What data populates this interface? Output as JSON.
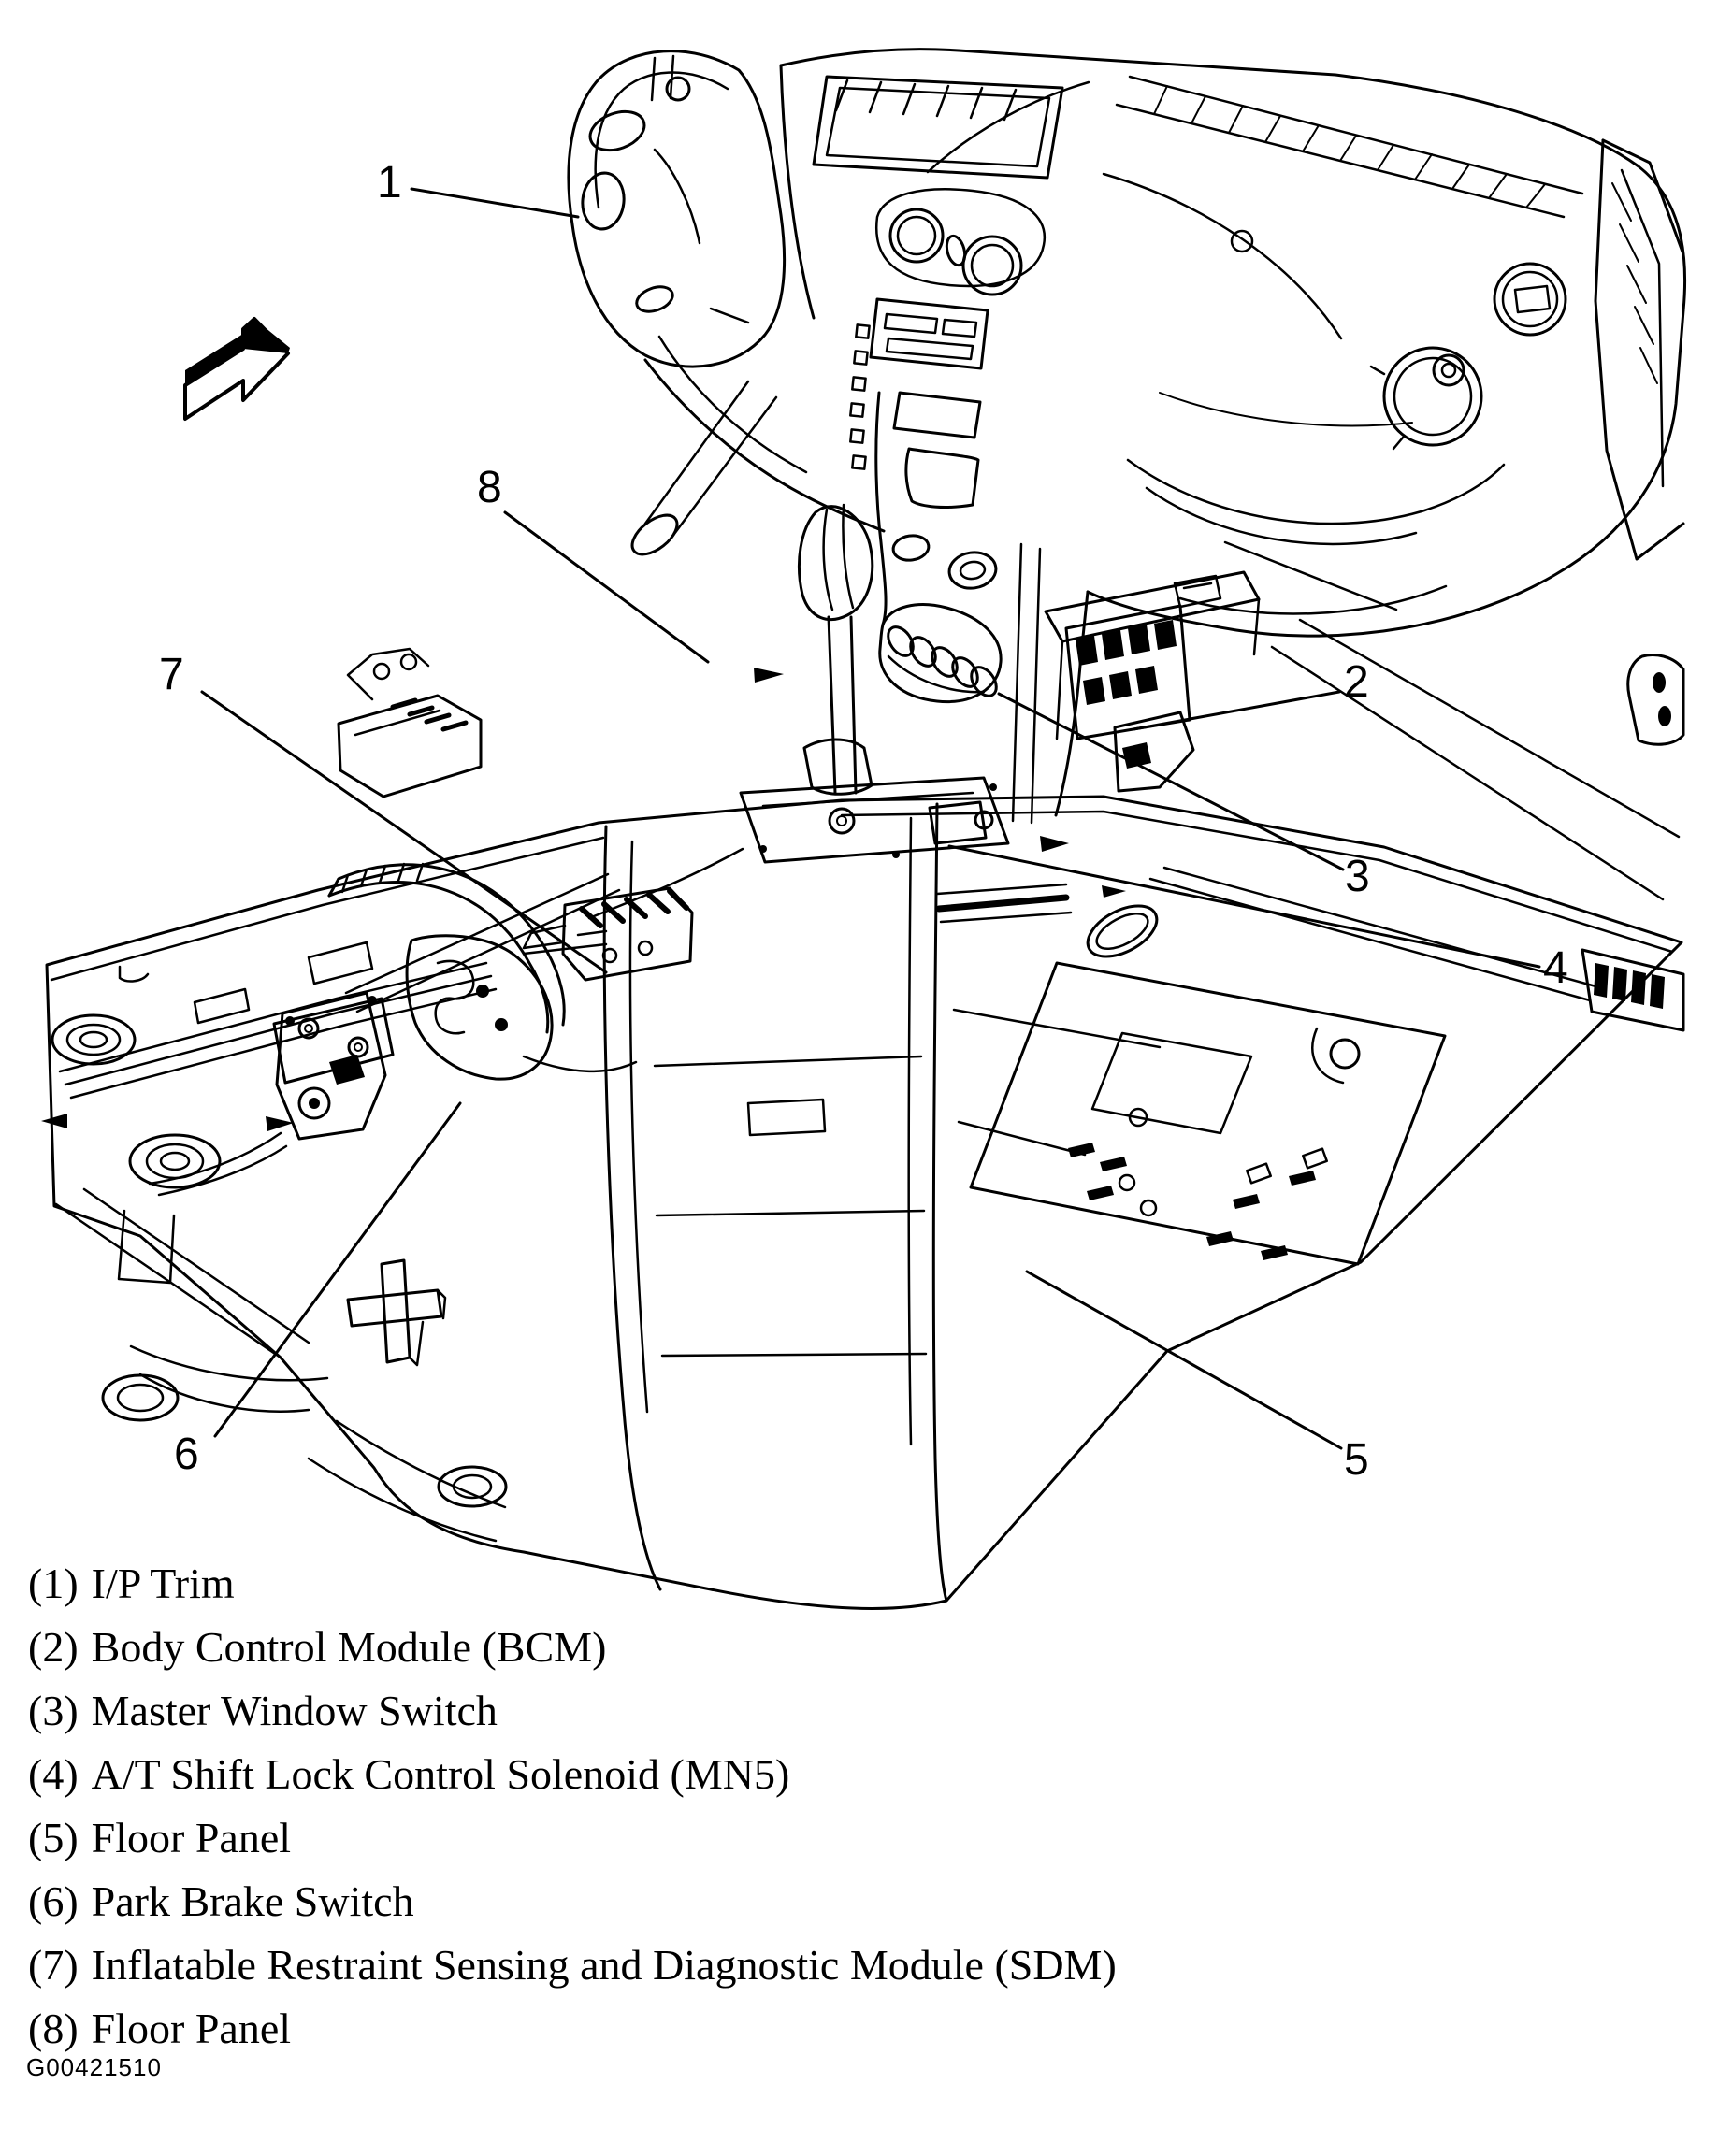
{
  "figure": {
    "code": "G00421510"
  },
  "colors": {
    "ink": "#000000",
    "paper": "#ffffff"
  },
  "callouts": [
    {
      "label": "1"
    },
    {
      "label": "2"
    },
    {
      "label": "3"
    },
    {
      "label": "4"
    },
    {
      "label": "5"
    },
    {
      "label": "6"
    },
    {
      "label": "7"
    },
    {
      "label": "8"
    }
  ],
  "legend": {
    "items": [
      {
        "number": "(1)",
        "label": "I/P Trim"
      },
      {
        "number": "(2)",
        "label": "Body Control Module (BCM)"
      },
      {
        "number": "(3)",
        "label": "Master Window Switch"
      },
      {
        "number": "(4)",
        "label": "A/T Shift Lock Control Solenoid (MN5)"
      },
      {
        "number": "(5)",
        "label": "Floor Panel"
      },
      {
        "number": "(6)",
        "label": "Park Brake Switch"
      },
      {
        "number": "(7)",
        "label": "Inflatable Restraint Sensing and Diagnostic Module (SDM)"
      },
      {
        "number": "(8)",
        "label": "Floor Panel"
      }
    ]
  }
}
